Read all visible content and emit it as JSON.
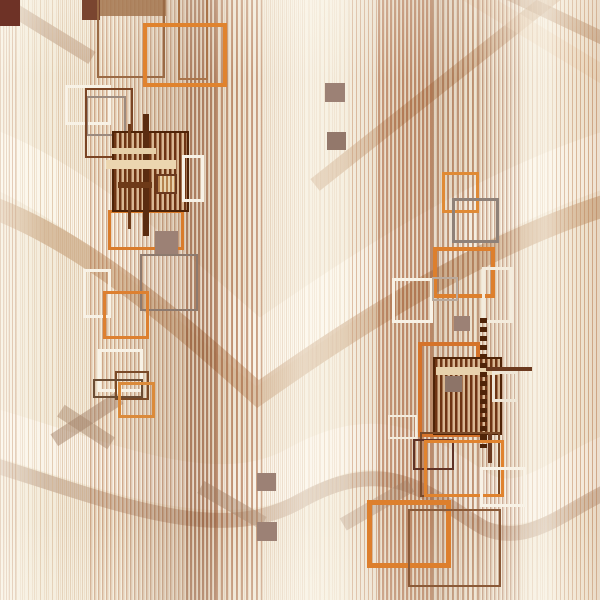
{
  "title": "Abstract geometric stripe pattern with square motifs",
  "canvas": {
    "width": 600,
    "height": 600,
    "base_color": "#f3ebda"
  },
  "palette": {
    "base_cream": "#f3ebda",
    "stripe_brown": "#a06a48",
    "stripe_tan": "#c99a6e",
    "accent_orange": "#e0832e",
    "accent_orange_dark": "#d5732a",
    "frame_white": "#f8f2e6",
    "frame_gray": "#8f8178",
    "frame_brown": "#7a4424",
    "frame_maroon": "#5f3226",
    "cluster_dark": "#6e3514",
    "cluster_light": "#d9b893",
    "filled_taupe": "#9c8175",
    "shade_taupe": "#a58a76"
  },
  "stripe_bands": [
    {
      "x": 0,
      "w": 600,
      "color": "rgba(200,155,115,0.22)",
      "s": 1,
      "p": 4
    },
    {
      "x": 0,
      "w": 16,
      "color": "rgba(180,120,80,0.50)",
      "s": 1,
      "p": 3
    },
    {
      "x": 16,
      "w": 42,
      "color": "rgba(215,185,150,0.50)",
      "s": 1,
      "p": 6
    },
    {
      "x": 58,
      "w": 32,
      "color": "rgba(205,168,130,0.50)",
      "s": 1,
      "p": 4
    },
    {
      "x": 90,
      "w": 40,
      "color": "rgba(175,112,68,0.55)",
      "s": 1.5,
      "p": 4
    },
    {
      "x": 130,
      "w": 56,
      "color": "rgba(160,95,52,0.50)",
      "s": 1.5,
      "p": 4
    },
    {
      "x": 186,
      "w": 30,
      "color": "rgba(140,72,34,0.60)",
      "s": 2,
      "p": 4
    },
    {
      "x": 216,
      "w": 46,
      "color": "rgba(158,86,44,0.55)",
      "s": 2,
      "p": 5
    },
    {
      "x": 262,
      "w": 42,
      "color": "rgba(205,165,128,0.45)",
      "s": 1,
      "p": 4
    },
    {
      "x": 304,
      "w": 48,
      "color": "rgba(225,198,165,0.45)",
      "s": 1,
      "p": 5
    },
    {
      "x": 352,
      "w": 26,
      "color": "rgba(188,124,80,0.50)",
      "s": 1,
      "p": 4
    },
    {
      "x": 378,
      "w": 54,
      "color": "rgba(165,88,45,0.60)",
      "s": 2,
      "p": 4
    },
    {
      "x": 432,
      "w": 46,
      "color": "rgba(158,92,52,0.55)",
      "s": 2,
      "p": 5
    },
    {
      "x": 478,
      "w": 44,
      "color": "rgba(148,80,42,0.50)",
      "s": 1.5,
      "p": 4
    },
    {
      "x": 522,
      "w": 34,
      "color": "rgba(212,178,142,0.45)",
      "s": 1,
      "p": 5
    },
    {
      "x": 556,
      "w": 44,
      "color": "rgba(190,134,92,0.50)",
      "s": 1,
      "p": 4
    }
  ],
  "waves": [
    {
      "name": "upper-u-highlight",
      "d": "M -30 150 C 80 185 195 300 258 352 C 335 300 480 195 630 152",
      "color": "rgba(253,248,238,0.78)",
      "width": 55
    },
    {
      "name": "upper-u-tan-band",
      "d": "M -30 200 C 80 232 195 338 258 394 C 335 340 480 240 630 198",
      "color": "rgba(198,160,122,0.60)",
      "width": 22
    },
    {
      "name": "lower-wave-highlight",
      "d": "M -30 425 C 90 458 215 518 300 468 C 390 418 432 468 482 496 C 532 518 572 468 630 450",
      "color": "rgba(252,247,238,0.72)",
      "width": 46
    },
    {
      "name": "lower-wave-tan-band",
      "d": "M -30 458 C 90 492 215 552 302 500 C 392 450 434 500 484 528 C 534 550 574 500 630 482",
      "color": "rgba(172,138,112,0.45)",
      "width": 15
    },
    {
      "name": "topright-diagonal-rising",
      "d": "M 315 185 L 580 -25",
      "color": "rgba(200,164,126,0.60)",
      "width": 15
    },
    {
      "name": "topright-diagonal-falling",
      "d": "M 490 -15 L 632 52",
      "color": "rgba(178,140,105,0.55)",
      "width": 13
    },
    {
      "name": "topright-diagonal-light",
      "d": "M 455 -15 L 632 92",
      "color": "rgba(236,216,190,0.60)",
      "width": 18
    },
    {
      "name": "topleft-diagonal",
      "d": "M -12 -6 L 92 58",
      "color": "rgba(175,140,112,0.50)",
      "width": 14
    }
  ],
  "shades": [
    {
      "x": 48,
      "y": 412,
      "w": 78,
      "h": 14,
      "rot": -33,
      "color": "rgba(164,130,105,0.50)"
    },
    {
      "x": 56,
      "y": 420,
      "w": 60,
      "h": 14,
      "rot": 33,
      "color": "rgba(164,130,105,0.45)"
    },
    {
      "x": 196,
      "y": 498,
      "w": 72,
      "h": 14,
      "rot": 30,
      "color": "rgba(164,130,105,0.45)"
    },
    {
      "x": 338,
      "y": 498,
      "w": 78,
      "h": 14,
      "rot": -30,
      "color": "rgba(164,130,105,0.40)"
    }
  ],
  "overlay_gradients": [
    "linear-gradient(90deg, rgba(255,252,244,0.55) 0px, rgba(255,252,244,0) 45px, rgba(255,252,244,0) 120px, rgba(120,66,32,0.12) 165px, rgba(120,66,32,0.16) 200px, rgba(120,66,32,0.02) 240px, rgba(255,252,244,0.45) 300px, rgba(255,252,244,0.30) 340px, rgba(120,66,32,0.10) 400px, rgba(120,66,32,0.15) 440px, rgba(120,66,32,0.03) 480px, rgba(255,252,244,0.45) 545px, rgba(200,150,105,0.12) 585px, rgba(160,100,60,0.15) 600px)",
    "linear-gradient(180deg, rgba(255,252,244,0.25) 0px, rgba(255,252,244,0) 80px, rgba(255,252,244,0) 520px, rgba(255,252,244,0.20) 600px)"
  ],
  "shapes": [
    {
      "type": "fill",
      "name": "topleft-dark-block",
      "x": 0,
      "y": 0,
      "w": 20,
      "h": 26,
      "color": "#6e3226"
    },
    {
      "type": "fill",
      "name": "top-brown-block",
      "x": 82,
      "y": 0,
      "w": 18,
      "h": 20,
      "color": "#7a4530"
    },
    {
      "type": "fill",
      "name": "top-brown-band",
      "x": 100,
      "y": 0,
      "w": 66,
      "h": 16,
      "color": "rgba(163,117,79,0.85)"
    },
    {
      "type": "frame",
      "name": "top-thin-brown-frame",
      "x": 97,
      "y": -22,
      "w": 68,
      "h": 100,
      "bw": 2,
      "color": "#9a6a45"
    },
    {
      "type": "frame",
      "name": "top-thin-brown-frame-2",
      "x": 178,
      "y": -14,
      "w": 30,
      "h": 94,
      "bw": 2,
      "color": "#a9744a"
    },
    {
      "type": "frame",
      "name": "top-orange-square",
      "x": 143,
      "y": 23,
      "w": 84,
      "h": 64,
      "bw": 4,
      "color": "#e0832e"
    },
    {
      "type": "frame",
      "name": "white-frame-upperleft",
      "x": 65,
      "y": 85,
      "w": 46,
      "h": 40,
      "bw": 3,
      "color": "#f8f2e6"
    },
    {
      "type": "frame",
      "name": "gray-frame-upperleft",
      "x": 86,
      "y": 96,
      "w": 40,
      "h": 40,
      "bw": 2,
      "color": "#9b8a7e"
    },
    {
      "type": "frame",
      "name": "brown-frame-upperleft",
      "x": 85,
      "y": 88,
      "w": 48,
      "h": 70,
      "bw": 2,
      "color": "#7a4424"
    },
    {
      "type": "frame",
      "name": "orange-frame-below-cluster",
      "x": 108,
      "y": 210,
      "w": 76,
      "h": 40,
      "bw": 3,
      "color": "#d97b2a"
    },
    {
      "type": "cluster",
      "name": "left-dark-cluster",
      "x": 112,
      "y": 131,
      "w": 77,
      "h": 81,
      "bw": 2,
      "border": "#4f2408",
      "dark": "#6e3514",
      "light": "#d9b893",
      "sw": 2.5,
      "period": 5
    },
    {
      "type": "bar",
      "name": "cluster-l-vline-1",
      "x": 143,
      "y": 114,
      "w": 6,
      "h": 122,
      "color": "#5a2c10"
    },
    {
      "type": "bar",
      "name": "cluster-l-vline-2",
      "x": 128,
      "y": 124,
      "w": 3,
      "h": 105,
      "color": "#6e3a18"
    },
    {
      "type": "bar",
      "name": "cluster-l-crossbar-light",
      "x": 106,
      "y": 160,
      "w": 70,
      "h": 9,
      "color": "#ecd6b0"
    },
    {
      "type": "bar",
      "name": "cluster-l-crossbar-light-2",
      "x": 112,
      "y": 148,
      "w": 44,
      "h": 6,
      "color": "#e6cfa8"
    },
    {
      "type": "bar",
      "name": "cluster-l-crossbar-dark",
      "x": 118,
      "y": 182,
      "w": 34,
      "h": 6,
      "color": "#6e3a18"
    },
    {
      "type": "cluster",
      "name": "cluster-l-inner-square",
      "x": 156,
      "y": 174,
      "w": 21,
      "h": 20,
      "bw": 2,
      "border": "#6b3a1f",
      "dark": "#b5824e",
      "light": "#e8d4ae",
      "sw": 2,
      "period": 4
    },
    {
      "type": "frame",
      "name": "white-frame-right-of-cluster",
      "x": 182,
      "y": 155,
      "w": 22,
      "h": 47,
      "bw": 3,
      "color": "#f8f2e6"
    },
    {
      "type": "fill",
      "name": "taupe-square-left",
      "x": 155,
      "y": 231,
      "w": 23,
      "h": 24,
      "color": "#9c8175"
    },
    {
      "type": "frame",
      "name": "gray-frame-midleft",
      "x": 140,
      "y": 254,
      "w": 58,
      "h": 57,
      "bw": 2,
      "color": "#8d7a6e"
    },
    {
      "type": "frame",
      "name": "white-frame-midleft",
      "x": 83,
      "y": 269,
      "w": 28,
      "h": 49,
      "bw": 3,
      "color": "#f8f2e6"
    },
    {
      "type": "frame",
      "name": "orange-frame-midleft",
      "x": 103,
      "y": 291,
      "w": 46,
      "h": 48,
      "bw": 3,
      "color": "#dd8030"
    },
    {
      "type": "frame",
      "name": "white-frame-lowerleft",
      "x": 98,
      "y": 349,
      "w": 45,
      "h": 43,
      "bw": 3,
      "color": "#f8f2e6"
    },
    {
      "type": "frame",
      "name": "brown-frame-lowerleft",
      "x": 115,
      "y": 371,
      "w": 34,
      "h": 29,
      "bw": 2,
      "color": "#7a4a28"
    },
    {
      "type": "frame",
      "name": "brown-frame-lowerleft-2",
      "x": 93,
      "y": 379,
      "w": 50,
      "h": 19,
      "bw": 2,
      "color": "#6b4c33"
    },
    {
      "type": "frame",
      "name": "orange-frame-lowerleft",
      "x": 118,
      "y": 382,
      "w": 37,
      "h": 36,
      "bw": 3,
      "color": "#db8a3a"
    },
    {
      "type": "fill",
      "name": "taupe-square-topcenter-1",
      "x": 325,
      "y": 83,
      "w": 20,
      "h": 19,
      "color": "#9c8175"
    },
    {
      "type": "fill",
      "name": "taupe-square-topcenter-2",
      "x": 327,
      "y": 132,
      "w": 19,
      "h": 18,
      "color": "#93786b"
    },
    {
      "type": "fill",
      "name": "taupe-square-bottomcenter-1",
      "x": 257,
      "y": 473,
      "w": 19,
      "h": 18,
      "color": "#9c8175"
    },
    {
      "type": "fill",
      "name": "taupe-square-bottomcenter-2",
      "x": 257,
      "y": 522,
      "w": 20,
      "h": 19,
      "color": "#9c8175"
    },
    {
      "type": "frame",
      "name": "white-frame-center-small",
      "x": 388,
      "y": 415,
      "w": 29,
      "h": 24,
      "bw": 2,
      "color": "#f4ecdd"
    },
    {
      "type": "frame",
      "name": "orange-frame-right-top",
      "x": 442,
      "y": 172,
      "w": 37,
      "h": 41,
      "bw": 3,
      "color": "#e08a35"
    },
    {
      "type": "frame",
      "name": "gray-frame-right",
      "x": 452,
      "y": 198,
      "w": 47,
      "h": 45,
      "bw": 3,
      "color": "#8f8178"
    },
    {
      "type": "frame",
      "name": "white-frame-right-mid",
      "x": 392,
      "y": 278,
      "w": 41,
      "h": 45,
      "bw": 3,
      "color": "#f8f2e6"
    },
    {
      "type": "frame",
      "name": "orange-frame-right-mid",
      "x": 433,
      "y": 247,
      "w": 62,
      "h": 51,
      "bw": 4,
      "color": "#dd7f2d"
    },
    {
      "type": "frame",
      "name": "gray-frame-right-small",
      "x": 432,
      "y": 277,
      "w": 26,
      "h": 24,
      "bw": 2,
      "color": "#b9a99c"
    },
    {
      "type": "frame",
      "name": "white-frame-right-tall",
      "x": 482,
      "y": 267,
      "w": 31,
      "h": 56,
      "bw": 3,
      "color": "#f4ecdd"
    },
    {
      "type": "fill",
      "name": "taupe-square-right",
      "x": 454,
      "y": 316,
      "w": 16,
      "h": 15,
      "color": "#9c8175"
    },
    {
      "type": "frame",
      "name": "orange-frame-right-cluster",
      "x": 418,
      "y": 342,
      "w": 62,
      "h": 95,
      "bw": 4,
      "color": "#d5732a"
    },
    {
      "type": "cluster",
      "name": "right-dark-cluster",
      "x": 433,
      "y": 357,
      "w": 69,
      "h": 78,
      "bw": 2,
      "border": "#4f2408",
      "dark": "#6e3514",
      "light": "#d9b893",
      "sw": 2.5,
      "period": 5
    },
    {
      "type": "bar",
      "name": "cluster-r-crossbar-light",
      "x": 436,
      "y": 367,
      "w": 63,
      "h": 8,
      "color": "#e8d2ac"
    },
    {
      "type": "fill",
      "name": "cluster-r-inner-taupe",
      "x": 445,
      "y": 376,
      "w": 17,
      "h": 16,
      "color": "#8d7468"
    },
    {
      "type": "bar",
      "name": "cluster-r-hline",
      "x": 486,
      "y": 367,
      "w": 46,
      "h": 4,
      "color": "#6b3a1f"
    },
    {
      "type": "dots",
      "name": "dotted-chain",
      "x": 480,
      "y": 318,
      "w": 7,
      "h": 130,
      "color": "#4f2408",
      "dot": 5,
      "gap": 4
    },
    {
      "type": "bar",
      "name": "cluster-r-vline-below",
      "x": 488,
      "y": 433,
      "w": 4,
      "h": 30,
      "color": "#6b3a1f"
    },
    {
      "type": "frame",
      "name": "white-frame-right-cluster",
      "x": 492,
      "y": 371,
      "w": 26,
      "h": 31,
      "bw": 3,
      "color": "#efe6d6"
    },
    {
      "type": "frame",
      "name": "brown-frame-bottomright",
      "x": 420,
      "y": 432,
      "w": 80,
      "h": 65,
      "bw": 2,
      "color": "#7a4a28"
    },
    {
      "type": "frame",
      "name": "maroon-frame-bottomright",
      "x": 413,
      "y": 439,
      "w": 41,
      "h": 31,
      "bw": 2,
      "color": "#5f3226"
    },
    {
      "type": "frame",
      "name": "orange-frame-bottomright",
      "x": 424,
      "y": 440,
      "w": 80,
      "h": 57,
      "bw": 3,
      "color": "#e0832e"
    },
    {
      "type": "frame",
      "name": "white-frame-bottomright",
      "x": 480,
      "y": 467,
      "w": 46,
      "h": 40,
      "bw": 3,
      "color": "#f8f2e6"
    },
    {
      "type": "frame",
      "name": "orange-frame-bottom-thick",
      "x": 367,
      "y": 500,
      "w": 84,
      "h": 68,
      "bw": 5,
      "color": "#dd7f2d"
    },
    {
      "type": "frame",
      "name": "brown-frame-bottom",
      "x": 408,
      "y": 509,
      "w": 93,
      "h": 78,
      "bw": 2,
      "color": "#8a5a38"
    }
  ]
}
